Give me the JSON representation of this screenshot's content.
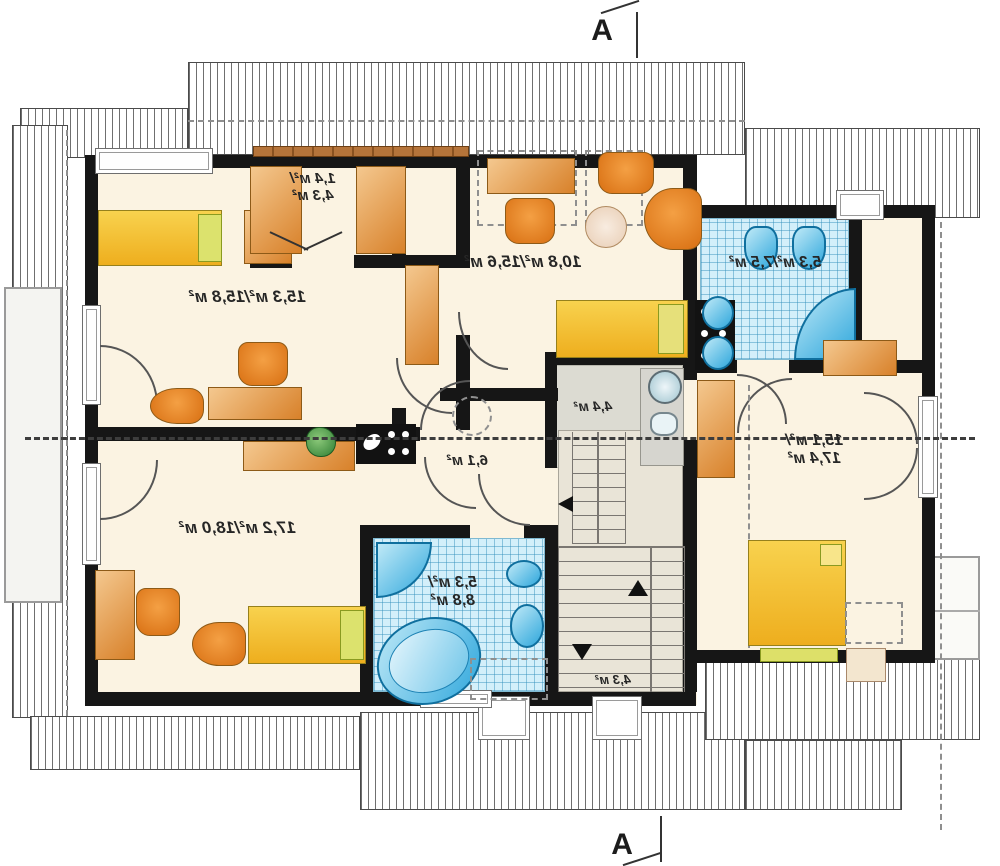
{
  "plan": {
    "type": "floor-plan",
    "mirrored": true,
    "section_markers": {
      "top": "A",
      "bottom": "A"
    },
    "rooms": {
      "bedroom_top_left": {
        "label": "15,3 м²/15,8 м²"
      },
      "wardrobe_nook": {
        "l1": "1,4 м²/",
        "l2": "4,3 м²"
      },
      "bedroom_top_middle": {
        "label": "10,8 м²/15,6 м²"
      },
      "bathroom_top": {
        "label": "5,3 м²/7,5 м²"
      },
      "bedroom_right": {
        "l1": "15,1 м²/",
        "l2": "17,4 м²"
      },
      "hallway": {
        "label": "6,1 м²"
      },
      "utility": {
        "label": "4,4 м²"
      },
      "staircase": {
        "label": "4,3 м²"
      },
      "bathroom_bottom": {
        "l1": "5,3 м²/",
        "l2": "8,8 м²"
      },
      "bedroom_bottom_left": {
        "label": "17,2 м²/18,0 м²"
      }
    },
    "colors": {
      "wall": "#161616",
      "floor": "#fbf3e2",
      "tile": "#d3effa",
      "furniture_wood": "#d8812a",
      "bed_yellow": "#f2c23a",
      "fixture_blue": "#3fb0e0",
      "stair_floor": "#e9e4d7"
    },
    "symbols": [
      "bed",
      "wardrobe",
      "desk",
      "chair",
      "armchair",
      "round-table",
      "plant",
      "toilet",
      "washbasin",
      "corner-shower",
      "corner-bathtub",
      "washing-machine",
      "chimney-flue",
      "stairs",
      "door-swing",
      "window",
      "roof-hatch",
      "section-line"
    ]
  }
}
